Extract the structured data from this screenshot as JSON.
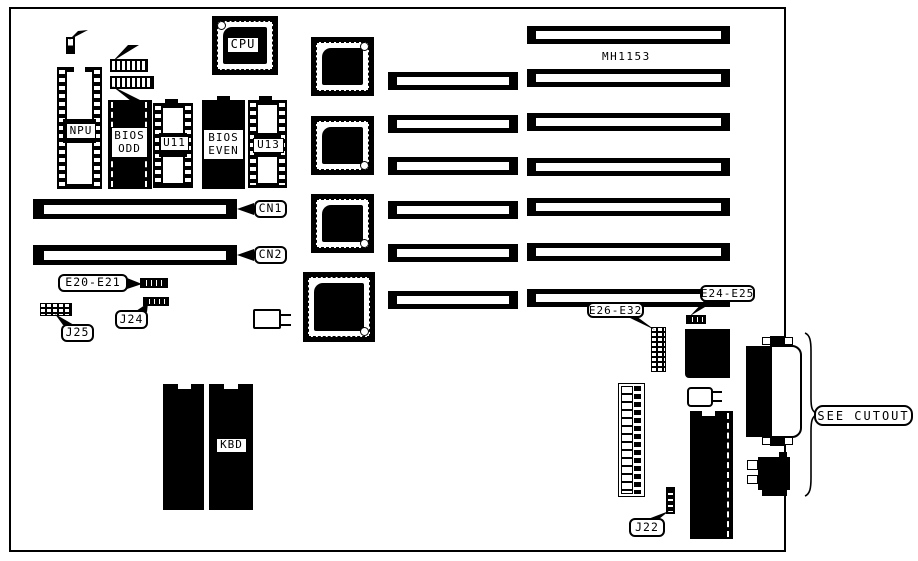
{
  "diagram": {
    "type": "motherboard-component-locator",
    "part_number": "MH1153",
    "cutout_note": "SEE CUTOUT",
    "components": {
      "cpu": "CPU",
      "npu": "NPU",
      "bios_odd": {
        "line1": "BIOS",
        "line2": "ODD"
      },
      "bios_even": {
        "line1": "BIOS",
        "line2": "EVEN"
      },
      "u11": "U11",
      "u13": "U13",
      "kbd": "KBD"
    },
    "connectors": {
      "cn1": "CN1",
      "cn2": "CN2"
    },
    "jumpers": {
      "e2": "E2",
      "e3_e8": "E3-E8",
      "e9_e15": "E9-E15",
      "e20_e21": "E20-E21",
      "e24_e25": "E24-E25",
      "e26_e32": "E26-E32",
      "j22": "J22",
      "j24": "J24",
      "j25": "J25"
    },
    "colors": {
      "ink": "#000000",
      "background": "#ffffff"
    }
  }
}
